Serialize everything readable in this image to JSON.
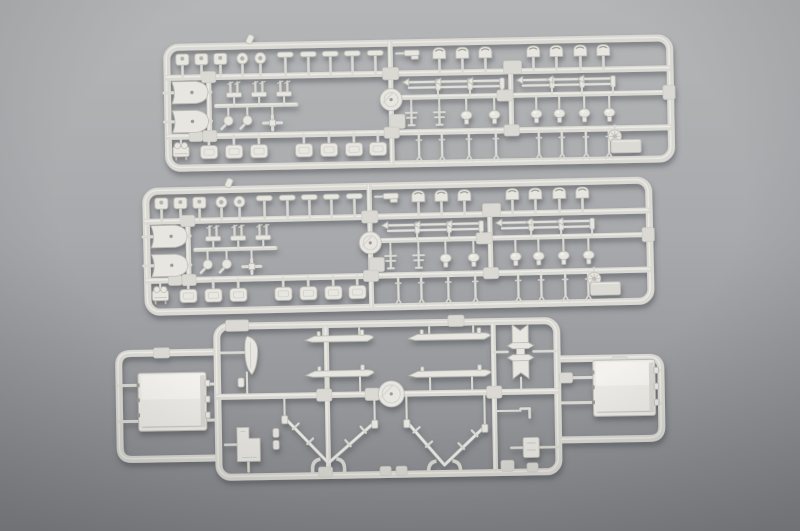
{
  "scene": {
    "description": "Photograph of three light gray injection-molded plastic model kit sprues (part runners) for a 1/700 warship model, laid on a neutral gray studio background. Two identical long rectangular sprues with many small deck fittings at top, one wide sprue with superstructure blocks, boat hulls, vee-shaped supports and a notched tower part at bottom.",
    "palette": {
      "bgTop": "#b5b6b8",
      "bgMid": "#a8a9ac",
      "bgBot": "#85878b",
      "vignette": "#26282c",
      "rail": "#dad9d3",
      "railHi": "#ecebe6",
      "face": "#e7e6e1",
      "faceHi": "#f3f2ee",
      "edge": "#bcbbb4",
      "dark": "#9b9a93",
      "hole": "#b3b2ac",
      "shadow": "#42444a"
    },
    "sprues": [
      {
        "id": "sprue-top",
        "template": "long",
        "x": 163,
        "y": 44,
        "rot": -1.1
      },
      {
        "id": "sprue-middle",
        "template": "long",
        "x": 142,
        "y": 188,
        "rot": -1.3
      },
      {
        "id": "sprue-bottom",
        "template": "wide",
        "x": 213,
        "y": 323,
        "rot": -1.0
      }
    ],
    "templates": {
      "long": {
        "frame": {
          "w": 510,
          "h": 128,
          "r": 12
        },
        "rails": [
          [
            3,
            34,
            506,
            34,
            6
          ],
          [
            3,
            93,
            506,
            93,
            6
          ],
          [
            236,
            58,
            506,
            58,
            5
          ],
          [
            227,
            3,
            227,
            125,
            5
          ],
          [
            347,
            34,
            347,
            93,
            5
          ],
          [
            45,
            34,
            45,
            93,
            5
          ],
          [
            52,
            63,
            132,
            63,
            4
          ]
        ],
        "pads": [
          [
            45,
            34,
            14,
            11
          ],
          [
            45,
            93,
            14,
            11
          ],
          [
            227,
            34,
            16,
            12
          ],
          [
            233,
            82,
            15,
            14
          ],
          [
            349,
            30,
            18,
            13
          ],
          [
            341,
            58,
            16,
            11
          ],
          [
            227,
            93,
            15,
            11
          ],
          [
            347,
            93,
            15,
            11
          ],
          [
            505,
            58,
            12,
            14
          ],
          [
            31,
            93,
            13,
            10
          ]
        ],
        "parts": [
          [
            "sq",
            19,
            16
          ],
          [
            "sq",
            38,
            16
          ],
          [
            "sq",
            57,
            16
          ],
          [
            "ring",
            79,
            16
          ],
          [
            "ring",
            97,
            16
          ],
          [
            "nub",
            87,
            -3,
            {
              "rot": 25
            }
          ],
          [
            "tee",
            122,
            13
          ],
          [
            "tee",
            145,
            13
          ],
          [
            "tee",
            167,
            13
          ],
          [
            "tee",
            189,
            13
          ],
          [
            "tee",
            212,
            13
          ],
          [
            "lgun",
            249,
            14
          ],
          [
            "vent",
            276,
            16
          ],
          [
            "vent",
            299,
            16
          ],
          [
            "vent",
            322,
            16
          ],
          [
            "vent",
            370,
            16
          ],
          [
            "vent",
            393,
            16
          ],
          [
            "vent",
            417,
            16
          ],
          [
            "vent",
            440,
            16
          ],
          [
            "fan",
            26,
            49
          ],
          [
            "fan",
            26,
            78
          ],
          [
            "gunpair",
            70,
            46
          ],
          [
            "gunpair",
            95,
            46
          ],
          [
            "gunpair",
            120,
            46
          ],
          [
            "comma",
            64,
            78
          ],
          [
            "comma",
            83,
            78
          ],
          [
            "cross",
            108,
            81
          ],
          [
            "disc",
            227,
            60,
            {
              "r": 11
            }
          ],
          [
            "davit",
            262,
            46
          ],
          [
            "davit",
            294,
            46
          ],
          [
            "davit",
            326,
            46
          ],
          [
            "davit",
            376,
            46
          ],
          [
            "davit",
            406,
            46
          ],
          [
            "davit",
            437,
            46
          ],
          [
            "mastfig",
            247,
            77
          ],
          [
            "mastfig",
            275,
            77
          ],
          [
            "ovalhead",
            302,
            77
          ],
          [
            "ovalhead",
            330,
            77
          ],
          [
            "ovalhead",
            372,
            77
          ],
          [
            "ovalhead",
            395,
            77
          ],
          [
            "ovalhead",
            420,
            77
          ],
          [
            "ovalhead",
            445,
            77
          ],
          [
            "machine",
            16,
            108
          ],
          [
            "plate",
            44,
            109
          ],
          [
            "plate",
            69,
            109
          ],
          [
            "plate",
            94,
            109
          ],
          [
            "plate",
            139,
            109
          ],
          [
            "plate",
            164,
            109
          ],
          [
            "plate",
            189,
            109
          ],
          [
            "plate",
            213,
            109
          ],
          [
            "pin",
            254,
            105
          ],
          [
            "pin",
            277,
            105
          ],
          [
            "pin",
            304,
            105
          ],
          [
            "pin",
            331,
            105
          ],
          [
            "pin",
            374,
            105
          ],
          [
            "pin",
            397,
            105
          ],
          [
            "pin",
            421,
            105
          ],
          [
            "pin",
            444,
            105
          ],
          [
            "wheel",
            450,
            101
          ],
          [
            "tag",
            461,
            111,
            {
              "w": 30,
              "h": 13
            }
          ]
        ]
      },
      "wide": {
        "frame": {
          "w": 347,
          "h": 158,
          "r": 12
        },
        "wings": [
          {
            "attach": 0,
            "tip": -95,
            "yTop": 29,
            "yBot": 135,
            "r": 12
          },
          {
            "attach": 347,
            "tip": 447,
            "yTop": 42,
            "yBot": 123,
            "r": 12
          }
        ],
        "rails": [
          [
            3,
            74,
            344,
            74,
            6
          ],
          [
            113,
            7,
            113,
            151,
            5
          ],
          [
            280,
            7,
            280,
            151,
            5
          ],
          [
            -95,
            61,
            -76,
            61,
            3
          ],
          [
            -95,
            97,
            -76,
            97,
            3
          ],
          [
            -9,
            61,
            0,
            61,
            3
          ],
          [
            -9,
            97,
            0,
            97,
            3
          ],
          [
            347,
            61,
            385,
            61,
            3
          ],
          [
            347,
            86,
            385,
            86,
            3
          ],
          [
            428,
            55,
            447,
            55,
            3
          ],
          [
            428,
            88,
            447,
            88,
            3
          ],
          [
            7,
            30,
            32,
            30,
            2.5
          ],
          [
            33,
            50,
            33,
            71,
            2
          ],
          [
            10,
            122,
            22,
            122,
            2.5
          ],
          [
            33,
            139,
            33,
            149,
            2.5
          ],
          [
            110,
            15,
            110,
            8,
            2
          ],
          [
            146,
            15,
            146,
            8,
            2
          ],
          [
            216,
            15,
            216,
            8,
            2
          ],
          [
            260,
            15,
            260,
            8,
            2
          ],
          [
            112,
            56,
            112,
            71,
            2
          ],
          [
            146,
            56,
            146,
            71,
            2
          ],
          [
            216,
            58,
            216,
            71,
            2
          ],
          [
            258,
            58,
            258,
            71,
            2
          ],
          [
            280,
            34,
            294,
            34,
            2.5
          ],
          [
            320,
            34,
            344,
            34,
            2.5
          ],
          [
            307,
            60,
            307,
            72,
            2
          ],
          [
            282,
            93,
            306,
            93,
            2
          ],
          [
            308,
            130,
            296,
            130,
            2.5
          ],
          [
            324,
            130,
            344,
            130,
            2.5
          ]
        ],
        "pads": [
          [
            24,
            3,
            23,
            11
          ],
          [
            243,
            2,
            16,
            11
          ],
          [
            110,
            74,
            15,
            12
          ],
          [
            158,
            74,
            14,
            12
          ],
          [
            280,
            74,
            15,
            12
          ],
          [
            110,
            151,
            14,
            10
          ],
          [
            292,
            148,
            13,
            11
          ],
          [
            -52,
            29,
            16,
            10
          ],
          [
            406,
            46,
            16,
            10
          ],
          [
            352,
            61,
            13,
            10
          ],
          [
            170,
            151,
            11,
            9
          ],
          [
            186,
            151,
            11,
            9
          ],
          [
            317,
            150,
            11,
            9
          ]
        ],
        "parts": [
          [
            "blade",
            38,
            33
          ],
          [
            "nub",
            27,
            60
          ],
          [
            "boot",
            33,
            122
          ],
          [
            "float",
            126,
            18,
            {
              "w": 68
            }
          ],
          [
            "float",
            236,
            18,
            {
              "w": 82
            }
          ],
          [
            "float",
            126,
            53,
            {
              "w": 68
            }
          ],
          [
            "float",
            236,
            55,
            {
              "w": 82
            }
          ],
          [
            "star",
            307,
            34
          ],
          [
            "disc",
            177,
            74,
            {
              "r": 13
            }
          ],
          [
            "vee",
            115,
            119,
            {
              "w": 90,
              "h": 46,
              "sy": 77,
              "by": 151
            }
          ],
          [
            "vee",
            231,
            124,
            {
              "w": 78,
              "h": 44,
              "sy": 77,
              "by": 151
            }
          ],
          [
            "lpart",
            311,
            95
          ],
          [
            "srect",
            316,
            130
          ],
          [
            "nub",
            61,
            111
          ],
          [
            "nub",
            61,
            123
          ],
          [
            "bigblock",
            -42,
            78,
            {
              "w": 68,
              "h": 58
            }
          ],
          [
            "bigblock",
            410,
            72,
            {
              "w": 62,
              "h": 56
            }
          ]
        ]
      }
    }
  }
}
